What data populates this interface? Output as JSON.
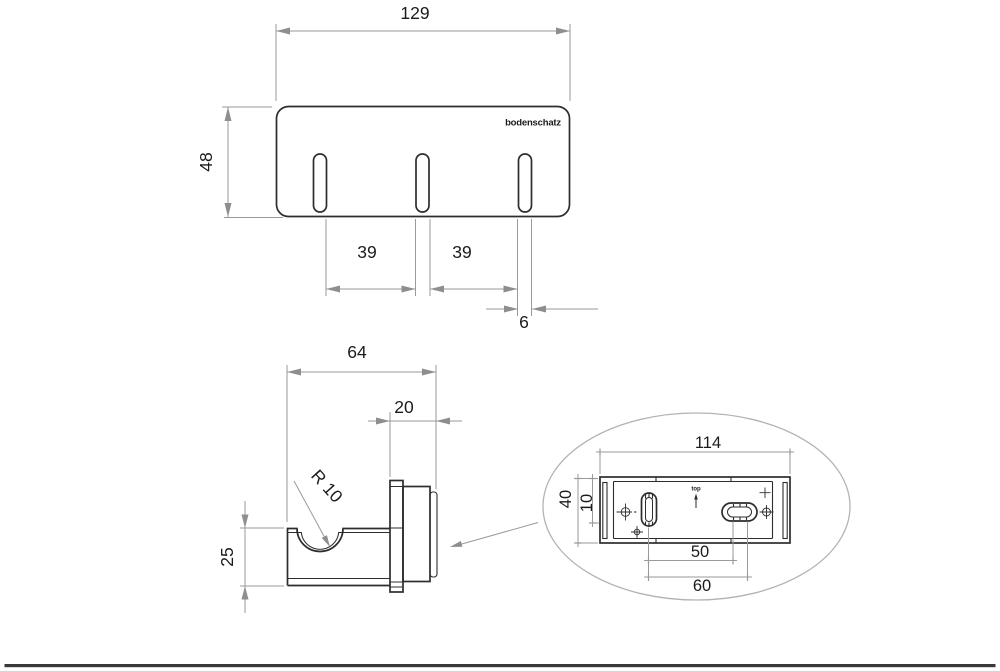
{
  "colors": {
    "outline": "#2d2d2d",
    "dimension_line": "#9a9a9a",
    "arrowhead": "#8e8e8e",
    "text": "#1b1b1b",
    "footer_bar": "#3a3a3a"
  },
  "front_view": {
    "logo": "bodenschatz",
    "width": "129",
    "height": "48",
    "hook_spacing_left": "39",
    "hook_spacing_right": "39",
    "hook_width": "6"
  },
  "side_view": {
    "total_depth": "64",
    "mount_depth": "20",
    "hook_height": "25",
    "notch_radius": "R 10"
  },
  "detail_view": {
    "plate_width": "114",
    "plate_height": "40",
    "top_offset": "10",
    "slot_spacing_near": "50",
    "slot_spacing_far": "60",
    "orientation": "top"
  }
}
